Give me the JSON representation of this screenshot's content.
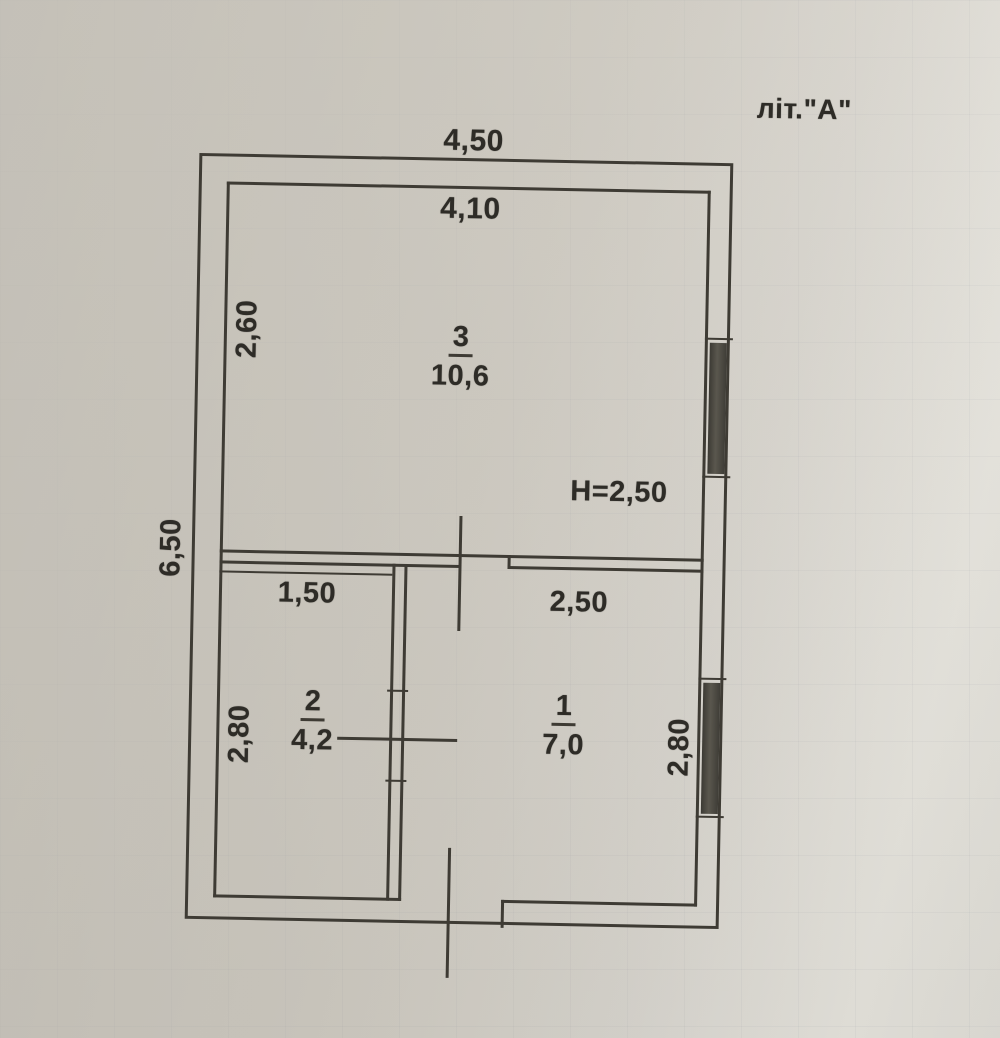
{
  "annotation": {
    "building_letter": "літ.\"А\""
  },
  "dimensions": {
    "outer_width": "4,50",
    "inner_width": "4,10",
    "outer_height": "6,50",
    "room3_height": "2,60",
    "ceiling_height": "H=2,50",
    "room2_width": "1,50",
    "room1_width": "2,50",
    "room2_height": "2,80",
    "room1_height": "2,80"
  },
  "rooms": [
    {
      "number": "3",
      "area": "10,6"
    },
    {
      "number": "2",
      "area": "4,2"
    },
    {
      "number": "1",
      "area": "7,0"
    }
  ],
  "colors": {
    "line": "#3e3b34",
    "text": "#2e2c27",
    "window_fill": "#45433c",
    "paper": "#cdc9c0"
  }
}
